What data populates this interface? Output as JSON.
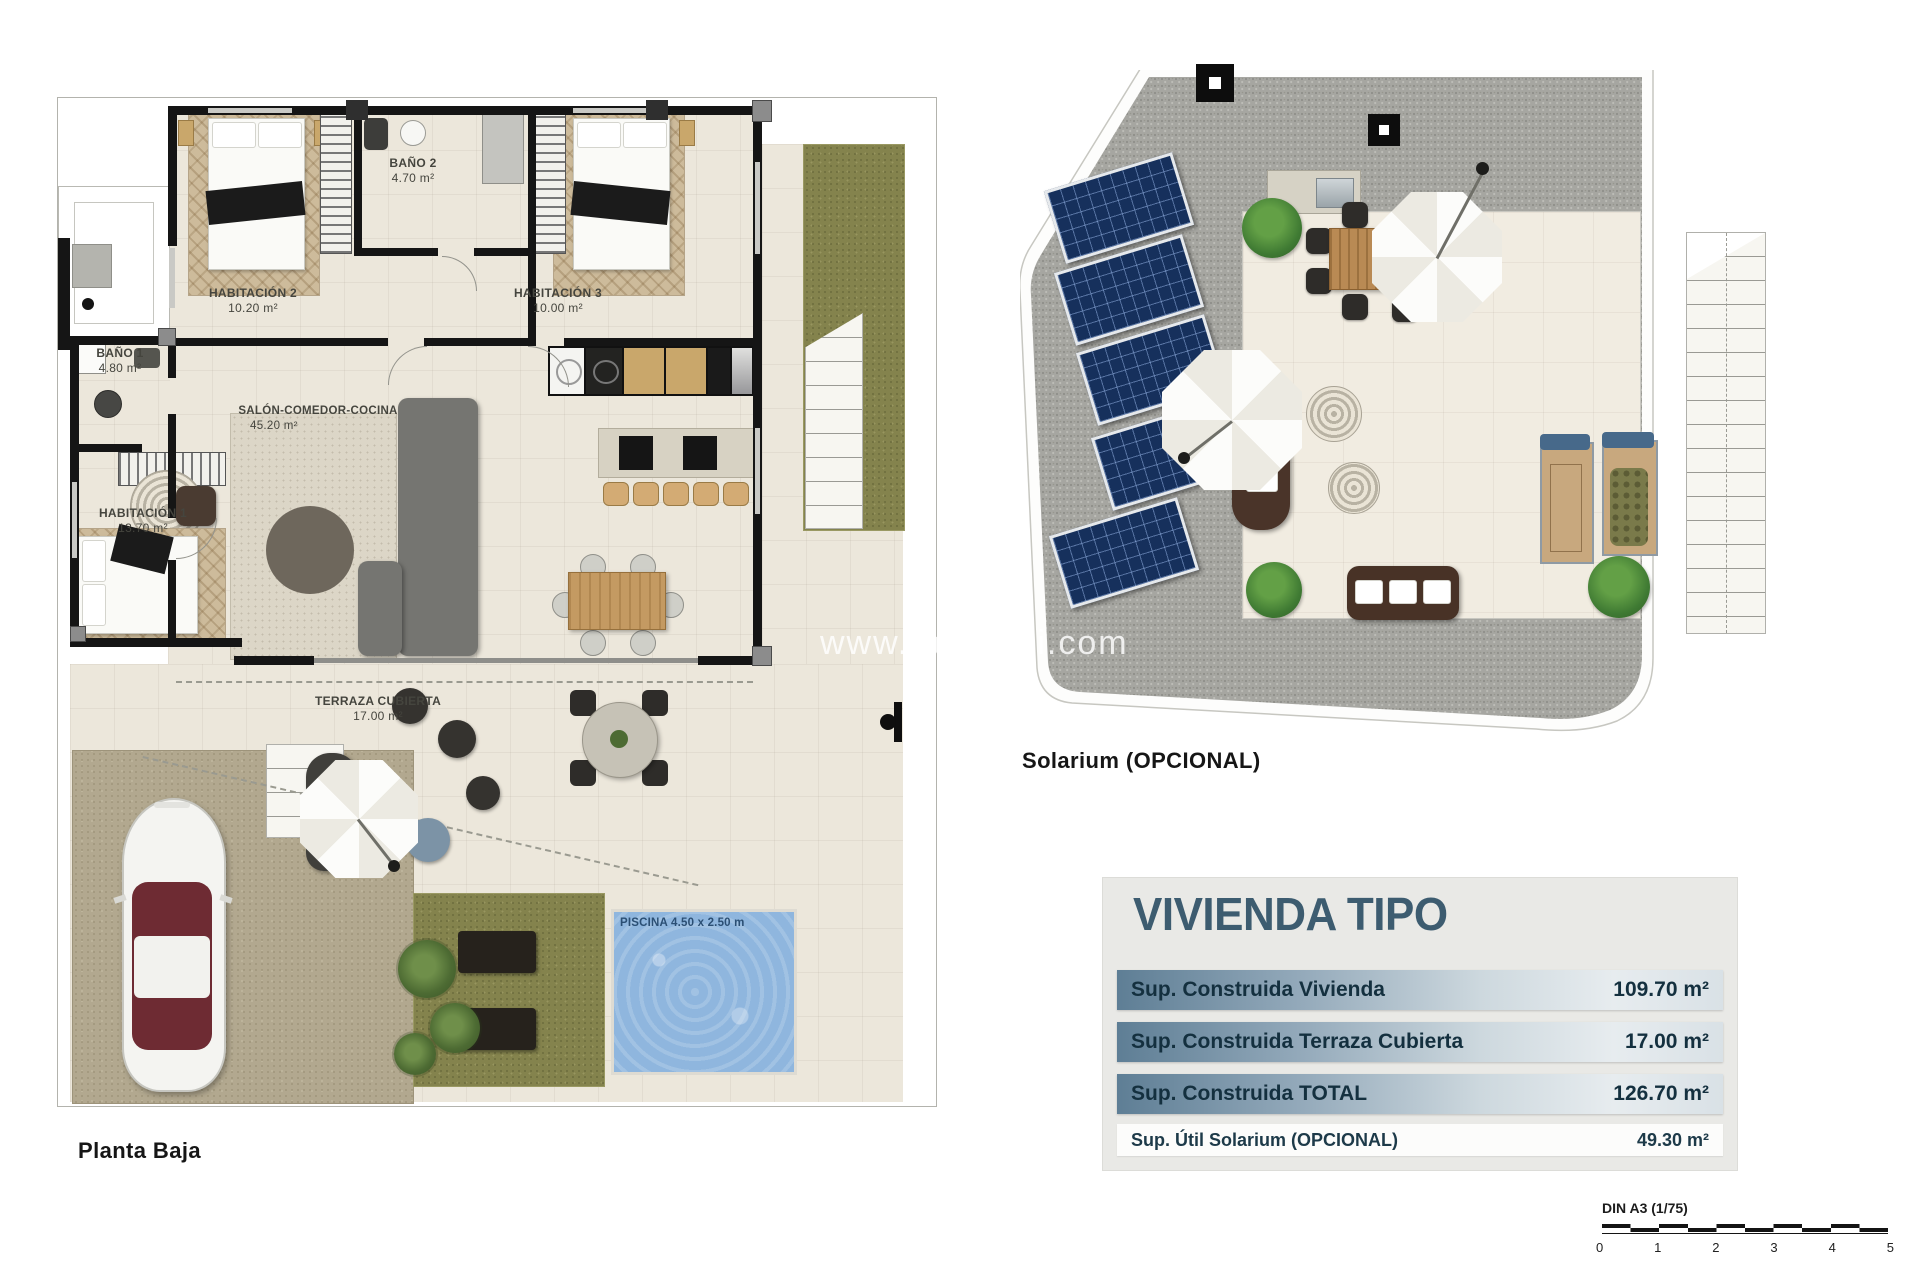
{
  "page": {
    "background": "#ffffff"
  },
  "watermark": {
    "left": "www.ray",
    "right": "bi.com"
  },
  "planta_baja": {
    "caption": "Planta Baja",
    "rooms": {
      "habitacion2": {
        "name": "HABITACIÓN 2",
        "area": "10.20 m²"
      },
      "bano2": {
        "name": "BAÑO 2",
        "area": "4.70 m²"
      },
      "habitacion3": {
        "name": "HABITACIÓN 3",
        "area": "10.00 m²"
      },
      "bano1": {
        "name": "BAÑO 1",
        "area": "4.80 m²"
      },
      "salon": {
        "name": "SALÓN-COMEDOR-COCINA",
        "area": "45.20 m²"
      },
      "habitacion1": {
        "name": "HABITACIÓN 1",
        "area": "13.70 m²"
      },
      "terraza": {
        "name": "TERRAZA CUBIERTA",
        "area": "17.00 m²"
      }
    },
    "pool_label": "PISCINA 4.50 x 2.50 m"
  },
  "solarium": {
    "caption": "Solarium (OPCIONAL)",
    "room_label": "SOLARIUM",
    "room_area": "49.30 m²"
  },
  "summary_table": {
    "title": "VIVIENDA TIPO",
    "rows": [
      {
        "label": "Sup. Construida Vivienda",
        "value": "109.70 m²"
      },
      {
        "label": "Sup. Construida Terraza Cubierta",
        "value": "17.00 m²"
      },
      {
        "label": "Sup. Construida TOTAL",
        "value": "126.70 m²"
      },
      {
        "label": "Sup. Útil Solarium (OPCIONAL)",
        "value": "49.30 m²"
      }
    ]
  },
  "scale_bar": {
    "label": "DIN A3 (1/75)",
    "ticks": [
      "0",
      "1",
      "2",
      "3",
      "4",
      "5"
    ]
  },
  "colors": {
    "table_title": "#3d5c70",
    "table_row_gradient_start": "#5e7e95",
    "table_row_gradient_end": "#d9e1e6",
    "pool_water": "#8fb6de",
    "pool_label_text": "#2b4f74",
    "grass": "#84834d",
    "gravel": "#a6a6a1",
    "solar_panel": "#16305c",
    "floor_cream": "#ece7db",
    "wall_black": "#151515",
    "wood": "#c49a62"
  }
}
